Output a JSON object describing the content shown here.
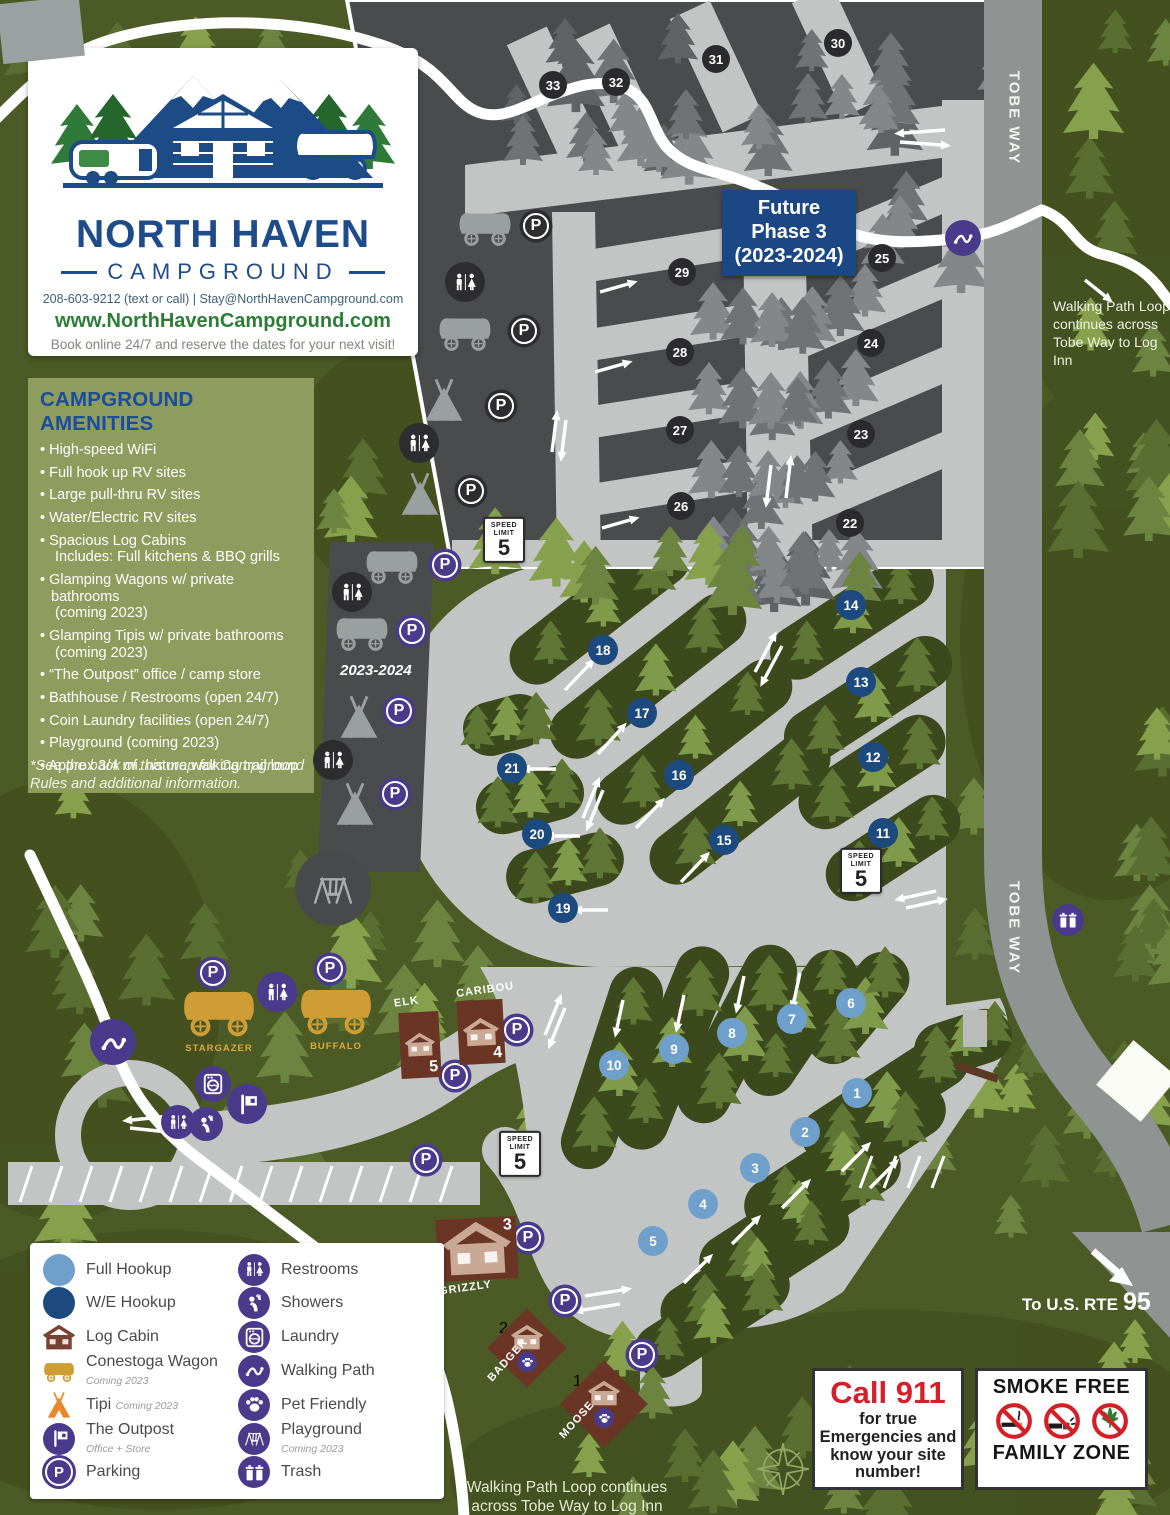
{
  "logo": {
    "title1": "NORTH HAVEN",
    "title2": "CAMPGROUND",
    "phone": "208-603-9212 (text or call)  |  Stay@NorthHavenCampground.com",
    "website": "www.NorthHavenCampground.com",
    "tagline": "Book online 24/7 and reserve the dates for your next visit!"
  },
  "amenities": {
    "title": "CAMPGROUND AMENITIES",
    "items": [
      {
        "text": "High-speed WiFi"
      },
      {
        "text": "Full hook up RV sites"
      },
      {
        "text": "Large pull-thru RV sites"
      },
      {
        "text": "Water/Electric RV sites"
      },
      {
        "text": "Spacious Log Cabins",
        "sub": "Includes: Full kitchens & BBQ grills"
      },
      {
        "text": "Glamping Wagons w/ private bathrooms",
        "sub": "(coming 2023)"
      },
      {
        "text": "Glamping Tipis w/ private bathrooms",
        "sub": "(coming 2023)"
      },
      {
        "text": "“The Outpost” office / camp store"
      },
      {
        "text": "Bathhouse / Restrooms (open 24/7)"
      },
      {
        "text": "Coin Laundry facilities (open 24/7)"
      },
      {
        "text": "Playground (coming 2023)"
      },
      {
        "text": "Approx 3/4 mi. nature walking trail loop"
      }
    ],
    "footnote": "*See the back of this map for Campground Rules and additional information."
  },
  "legend": {
    "left": [
      {
        "icon": "full",
        "label": "Full Hookup"
      },
      {
        "icon": "we",
        "label": "W/E Hookup"
      },
      {
        "icon": "cabin",
        "label": "Log Cabin"
      },
      {
        "icon": "wagon",
        "label": "Conestoga Wagon",
        "sub": "Coming 2023"
      },
      {
        "icon": "tipi",
        "label": "Tipi",
        "sub": "Coming 2023",
        "sub_inline": true
      },
      {
        "icon": "outpost",
        "label": "The Outpost",
        "sub": "Office + Store"
      },
      {
        "icon": "parking",
        "label": "Parking"
      }
    ],
    "right": [
      {
        "icon": "restrooms",
        "label": "Restrooms"
      },
      {
        "icon": "showers",
        "label": "Showers"
      },
      {
        "icon": "laundry",
        "label": "Laundry"
      },
      {
        "icon": "walkpath",
        "label": "Walking Path"
      },
      {
        "icon": "paw",
        "label": "Pet Friendly"
      },
      {
        "icon": "playground",
        "label": "Playground",
        "sub": "Coming 2023"
      },
      {
        "icon": "trash",
        "label": "Trash"
      }
    ]
  },
  "map": {
    "future_box": "Future\nPhase 3\n(2023-2024)",
    "strip_label": "2023-2024",
    "road_name": "TOBE WAY",
    "speed": {
      "top": "SPEED",
      "mid": "LIMIT",
      "value": "5"
    },
    "note_right": "Walking Path Loop continues across Tobe Way to Log Inn",
    "note_bottom": "Walking Path Loop continues across Tobe Way to Log Inn",
    "route_prefix": "To U.S. RTE",
    "route_number": "95",
    "sites": [
      {
        "number": 1,
        "type": "full"
      },
      {
        "number": 2,
        "type": "full"
      },
      {
        "number": 3,
        "type": "full"
      },
      {
        "number": 4,
        "type": "full"
      },
      {
        "number": 5,
        "type": "full"
      },
      {
        "number": 6,
        "type": "full"
      },
      {
        "number": 7,
        "type": "full"
      },
      {
        "number": 8,
        "type": "full"
      },
      {
        "number": 9,
        "type": "full"
      },
      {
        "number": 10,
        "type": "full"
      },
      {
        "number": 11,
        "type": "we"
      },
      {
        "number": 12,
        "type": "we"
      },
      {
        "number": 13,
        "type": "we"
      },
      {
        "number": 14,
        "type": "we"
      },
      {
        "number": 15,
        "type": "we"
      },
      {
        "number": 16,
        "type": "we"
      },
      {
        "number": 17,
        "type": "we"
      },
      {
        "number": 18,
        "type": "we"
      },
      {
        "number": 19,
        "type": "we"
      },
      {
        "number": 20,
        "type": "we"
      },
      {
        "number": 21,
        "type": "we"
      },
      {
        "number": 22,
        "type": "p3"
      },
      {
        "number": 23,
        "type": "p3"
      },
      {
        "number": 24,
        "type": "p3"
      },
      {
        "number": 25,
        "type": "p3"
      },
      {
        "number": 26,
        "type": "p3"
      },
      {
        "number": 27,
        "type": "p3"
      },
      {
        "number": 28,
        "type": "p3"
      },
      {
        "number": 29,
        "type": "p3"
      },
      {
        "number": 30,
        "type": "p3"
      },
      {
        "number": 31,
        "type": "p3"
      },
      {
        "number": 32,
        "type": "p3"
      },
      {
        "number": 33,
        "type": "p3"
      }
    ],
    "cabins": [
      {
        "name": "ELK",
        "number": "5"
      },
      {
        "name": "CARIBOU",
        "number": "4"
      },
      {
        "name": "GRIZZLY",
        "number": "3"
      },
      {
        "name": "BADGER",
        "number": "2"
      },
      {
        "name": "MOOSE",
        "number": "1"
      }
    ],
    "wagon_sites": [
      "STARGAZER",
      "BUFFALO"
    ]
  },
  "notices": {
    "call911": {
      "title": "Call 911",
      "body": "for true Emergencies and know your site number!"
    },
    "smokefree": {
      "top": "SMOKE FREE",
      "bottom": "FAMILY ZONE"
    }
  },
  "colors": {
    "background_green": "#4c5a26",
    "road_light": "#c2c5c3",
    "road_dark": "#8f9392",
    "phase3_dark": "#494b4d",
    "purple_icon": "#4a3a8c",
    "full_hookup_blue": "#6fa0cc",
    "we_hookup_navy": "#1c4a7e",
    "cabin_brown": "#6b3526",
    "wagon_gold": "#cf9d35",
    "brand_blue": "#1e4c8a",
    "brand_green": "#2e7d36",
    "alert_red": "#d5202a"
  }
}
